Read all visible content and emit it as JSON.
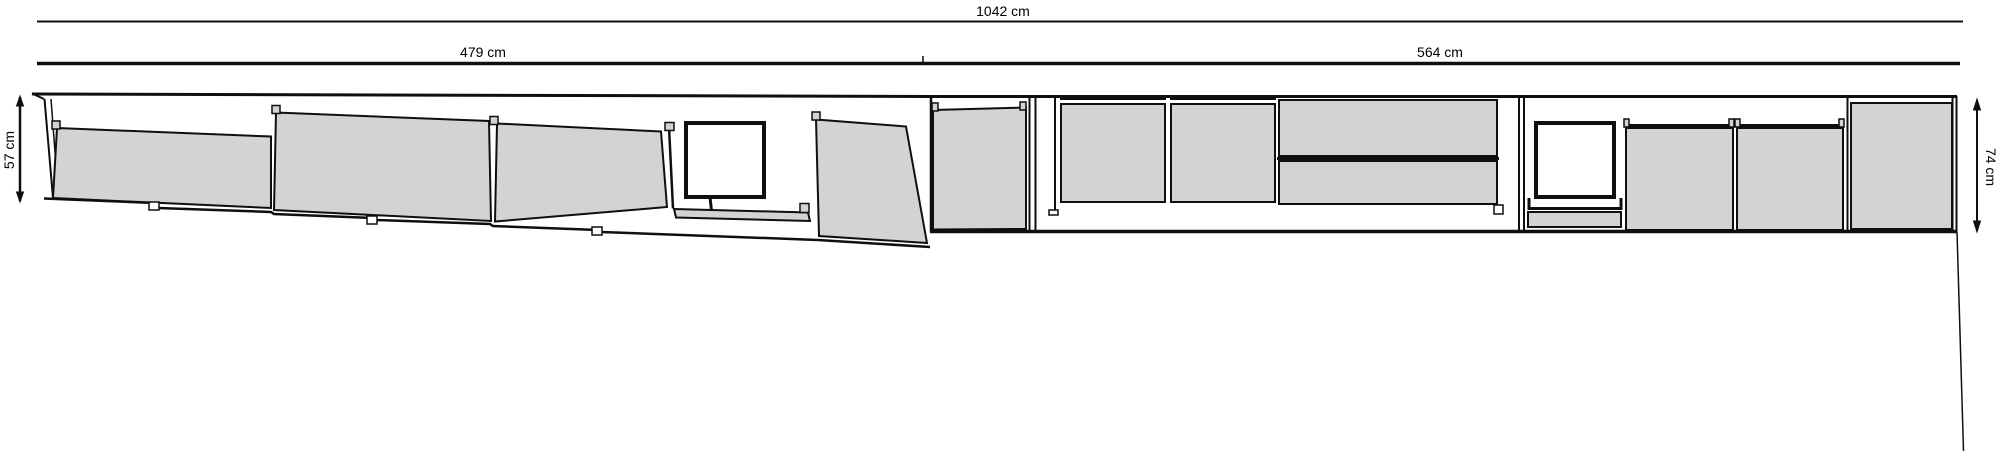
{
  "drawing": {
    "title": "cabinet-run-elevation",
    "colors": {
      "panel": "#d3d3d3",
      "stroke": "#0f0f0f",
      "background": "#ffffff",
      "white": "#ffffff"
    },
    "dimensions": {
      "total": {
        "label": "1042 cm"
      },
      "left_width": {
        "label": "479 cm"
      },
      "right_width": {
        "label": "564 cm"
      },
      "left_height": {
        "label": "57 cm"
      },
      "right_height": {
        "label": "74 cm"
      }
    },
    "groups": [
      {
        "name": "dimension-lines",
        "shapes": [
          {
            "k": "line",
            "p": [
              37,
              21.5,
              1963,
              21.5
            ],
            "s": 2,
            "name": "dim-line-total"
          },
          {
            "k": "line",
            "p": [
              37,
              63.5,
              923,
              63.5
            ],
            "s": 3.5,
            "name": "dim-line-left-width"
          },
          {
            "k": "line",
            "p": [
              923,
              63.5,
              1960,
              63.5
            ],
            "s": 3.5,
            "name": "dim-line-right-width"
          },
          {
            "k": "line",
            "p": [
              923,
              56,
              923,
              62
            ],
            "s": 1.5,
            "name": "dim-junction-tick"
          },
          {
            "k": "line",
            "p": [
              20,
              97,
              20,
              201
            ],
            "s": 2.5,
            "name": "dim-line-left-height"
          },
          {
            "k": "poly",
            "p": [
              16.5,
              106,
              23.5,
              106,
              20,
              96
            ],
            "f": "k",
            "s": 1,
            "name": "arrow-up-icon"
          },
          {
            "k": "poly",
            "p": [
              16.5,
              192,
              23.5,
              192,
              20,
              202
            ],
            "f": "k",
            "s": 1,
            "name": "arrow-down-icon"
          },
          {
            "k": "line",
            "p": [
              1977,
              100,
              1977,
              231
            ],
            "s": 2,
            "name": "dim-line-right-height"
          },
          {
            "k": "poly",
            "p": [
              1973.5,
              110,
              1980.5,
              110,
              1977,
              99
            ],
            "f": "k",
            "s": 1,
            "name": "arrow-up-icon"
          },
          {
            "k": "poly",
            "p": [
              1973.5,
              221,
              1980.5,
              221,
              1977,
              232
            ],
            "f": "k",
            "s": 1,
            "name": "arrow-down-icon"
          },
          {
            "k": "text",
            "x": 1003,
            "y": 16,
            "bind": "drawing.dimensions.total.label",
            "name": "dim-total-label"
          },
          {
            "k": "text",
            "x": 483,
            "y": 57,
            "bind": "drawing.dimensions.left_width.label",
            "name": "dim-left-width-label"
          },
          {
            "k": "text",
            "x": 1440,
            "y": 57,
            "bind": "drawing.dimensions.right_width.label",
            "name": "dim-right-width-label"
          },
          {
            "k": "text",
            "x": 14,
            "y": 150,
            "rot": -90,
            "bind": "drawing.dimensions.left_height.label",
            "name": "dim-left-height-label"
          },
          {
            "k": "text",
            "x": 1986,
            "y": 167,
            "rot": 90,
            "bind": "drawing.dimensions.right_height.label",
            "name": "dim-right-height-label"
          }
        ]
      },
      {
        "name": "left-run-oblique",
        "shapes": [
          {
            "k": "pline",
            "p": [
              44,
              198.5,
              155,
              203,
              158,
              208,
              271,
              212,
              274,
              214,
              373,
              218,
              376,
              220,
              490,
              224,
              493,
              226,
              598,
              230,
              601,
              232,
              818,
              240,
              930,
              247
            ],
            "s": 2.5,
            "name": "base-outline"
          },
          {
            "k": "line",
            "p": [
              32,
              94,
              930,
              96.5
            ],
            "s": 3,
            "name": "top-edge"
          },
          {
            "k": "line",
            "p": [
              32,
              93.5,
              44,
              99
            ],
            "s": 2,
            "name": "top-left-tip"
          },
          {
            "k": "line",
            "p": [
              44.5,
              99,
              53,
              198
            ],
            "s": 2,
            "name": "end-panel-edge"
          },
          {
            "k": "line",
            "p": [
              51,
              99,
              58.5,
              198
            ],
            "s": 1.5,
            "name": "end-panel-edge"
          },
          {
            "k": "poly",
            "p": [
              57,
              128,
              271,
              136.5,
              271,
              208,
              53,
              198
            ],
            "f": "g",
            "s": 2,
            "name": "panel-front"
          },
          {
            "k": "rect",
            "p": [
              52,
              121,
              8,
              8
            ],
            "f": "g",
            "s": 1.5,
            "name": "hinge-tab"
          },
          {
            "k": "poly",
            "p": [
              276,
              112.5,
              489,
              121,
              491,
              221,
              274,
              210
            ],
            "f": "g",
            "s": 2,
            "name": "panel-front"
          },
          {
            "k": "rect",
            "p": [
              272,
              105.5,
              8,
              8
            ],
            "f": "g",
            "s": 1.5,
            "name": "hinge-tab"
          },
          {
            "k": "poly",
            "p": [
              497,
              123.5,
              661,
              131.5,
              667,
              207,
              495,
              221.5
            ],
            "f": "g",
            "s": 2,
            "name": "panel-front"
          },
          {
            "k": "rect",
            "p": [
              490,
              116.5,
              8,
              8
            ],
            "f": "g",
            "s": 1.5,
            "name": "hinge-tab"
          },
          {
            "k": "line",
            "p": [
              669,
              127,
              673,
              208.5
            ],
            "s": 2.5,
            "name": "divider"
          },
          {
            "k": "rect",
            "p": [
              665,
              122.5,
              9,
              8
            ],
            "f": "g",
            "s": 1.5,
            "name": "hinge-tab"
          },
          {
            "k": "rect",
            "p": [
              686,
              123,
              78,
              74
            ],
            "f": "w",
            "s": 4,
            "name": "window-opening"
          },
          {
            "k": "line",
            "p": [
              710,
              197,
              711.5,
              211
            ],
            "s": 3,
            "name": "window-stem"
          },
          {
            "k": "poly",
            "p": [
              674,
              209,
              808,
              212.5,
              810,
              221,
              676,
              217.5
            ],
            "f": "g",
            "s": 2,
            "name": "sill-strip"
          },
          {
            "k": "rect",
            "p": [
              800,
              203.5,
              9,
              9
            ],
            "f": "g",
            "s": 1.5,
            "name": "hinge-tab"
          },
          {
            "k": "poly",
            "p": [
              816,
              119.5,
              906,
              126.5,
              927,
              243,
              819,
              236
            ],
            "f": "g",
            "s": 2,
            "name": "open-door-panel"
          },
          {
            "k": "rect",
            "p": [
              812,
              112,
              8,
              8
            ],
            "f": "g",
            "s": 1.5,
            "name": "hinge-tab"
          },
          {
            "k": "rect",
            "p": [
              149,
              202,
              10,
              8
            ],
            "f": "w",
            "s": 1.5,
            "name": "foot"
          },
          {
            "k": "rect",
            "p": [
              367,
              216,
              10,
              8
            ],
            "f": "w",
            "s": 1.5,
            "name": "foot"
          },
          {
            "k": "rect",
            "p": [
              592,
              227,
              10,
              8
            ],
            "f": "w",
            "s": 1.5,
            "name": "foot"
          }
        ]
      },
      {
        "name": "right-run-elevation",
        "shapes": [
          {
            "k": "poly",
            "p": [
              933,
              110,
              1026,
              107.5,
              1026,
              229,
              933,
              229.5
            ],
            "f": "g",
            "s": 2,
            "name": "base-door"
          },
          {
            "k": "rect",
            "p": [
              932,
              103,
              6,
              8
            ],
            "f": "g",
            "s": 1.5,
            "name": "hinge-tab"
          },
          {
            "k": "rect",
            "p": [
              1020,
              102,
              6,
              8
            ],
            "f": "g",
            "s": 1.5,
            "name": "hinge-tab"
          },
          {
            "k": "line",
            "p": [
              1029.5,
              97,
              1029.5,
              231
            ],
            "s": 2,
            "name": "divider"
          },
          {
            "k": "line",
            "p": [
              1035.5,
              97,
              1035.5,
              231
            ],
            "s": 2,
            "name": "divider"
          },
          {
            "k": "line",
            "p": [
              1055,
              98,
              1055,
              212
            ],
            "s": 2,
            "name": "side-edge"
          },
          {
            "k": "rect",
            "p": [
              1049,
              210,
              9,
              5
            ],
            "f": "w",
            "s": 1.5,
            "name": "foot"
          },
          {
            "k": "line",
            "p": [
              1060,
              99,
              1166,
              99
            ],
            "s": 2,
            "name": "cabinet-top-rail"
          },
          {
            "k": "rect",
            "p": [
              1061,
              104,
              104,
              98
            ],
            "f": "g",
            "s": 2,
            "name": "wall-door"
          },
          {
            "k": "line",
            "p": [
              1170,
              99,
              1276,
              99
            ],
            "s": 2,
            "name": "cabinet-top-rail"
          },
          {
            "k": "rect",
            "p": [
              1171,
              104,
              104,
              98
            ],
            "f": "g",
            "s": 2,
            "name": "wall-door"
          },
          {
            "k": "rect",
            "p": [
              1279,
              100,
              218,
              56
            ],
            "f": "g",
            "s": 2,
            "name": "drawer-front"
          },
          {
            "k": "line",
            "p": [
              1277,
              158.5,
              1499,
              158.5
            ],
            "s": 3,
            "name": "drawer-divider"
          },
          {
            "k": "rect",
            "p": [
              1279,
              161,
              218,
              43
            ],
            "f": "g",
            "s": 2,
            "name": "drawer-front"
          },
          {
            "k": "rect",
            "p": [
              1494,
              205,
              9,
              9
            ],
            "f": "w",
            "s": 1.5,
            "name": "foot"
          },
          {
            "k": "line",
            "p": [
              1519,
              97,
              1519,
              232
            ],
            "s": 2,
            "name": "side-panel"
          },
          {
            "k": "line",
            "p": [
              1524,
              97,
              1524,
              232
            ],
            "s": 2,
            "name": "side-panel"
          },
          {
            "k": "rect",
            "p": [
              1536,
              123,
              78,
              74
            ],
            "f": "w",
            "s": 4,
            "name": "window-opening"
          },
          {
            "k": "pline",
            "p": [
              1529,
              198,
              1529,
              208.5,
              1621,
              208.5,
              1621,
              198
            ],
            "s": 3,
            "name": "window-sill"
          },
          {
            "k": "rect",
            "p": [
              1528,
              212,
              93,
              15
            ],
            "f": "g",
            "s": 2,
            "name": "sill-strip"
          },
          {
            "k": "line",
            "p": [
              1625,
              125.5,
              1734,
              125.5
            ],
            "s": 3,
            "name": "cabinet-top-rail"
          },
          {
            "k": "rect",
            "p": [
              1624,
              119,
              5,
              8
            ],
            "f": "g",
            "s": 1.5,
            "name": "hinge-tab"
          },
          {
            "k": "rect",
            "p": [
              1729,
              119,
              5,
              8
            ],
            "f": "g",
            "s": 1.5,
            "name": "hinge-tab"
          },
          {
            "k": "rect",
            "p": [
              1626,
              128,
              107,
              102
            ],
            "f": "g",
            "s": 2,
            "name": "base-door"
          },
          {
            "k": "line",
            "p": [
              1736,
              125.5,
              1844,
              125.5
            ],
            "s": 3,
            "name": "cabinet-top-rail"
          },
          {
            "k": "rect",
            "p": [
              1735,
              119,
              5,
              8
            ],
            "f": "g",
            "s": 1.5,
            "name": "hinge-tab"
          },
          {
            "k": "rect",
            "p": [
              1839,
              119,
              5,
              8
            ],
            "f": "g",
            "s": 1.5,
            "name": "hinge-tab"
          },
          {
            "k": "rect",
            "p": [
              1737,
              128,
              106,
              102
            ],
            "f": "g",
            "s": 2,
            "name": "base-door"
          },
          {
            "k": "line",
            "p": [
              1847.5,
              97,
              1847.5,
              231
            ],
            "s": 2,
            "name": "divider"
          },
          {
            "k": "rect",
            "p": [
              1851,
              103,
              101,
              126
            ],
            "f": "g",
            "s": 2,
            "name": "tall-end-door"
          },
          {
            "k": "line",
            "p": [
              930,
              96.5,
              1957,
              96.5
            ],
            "s": 3,
            "name": "top-edge"
          },
          {
            "k": "line",
            "p": [
              930,
              231.5,
              1957,
              231.5
            ],
            "s": 3.5,
            "name": "bottom-edge"
          },
          {
            "k": "line",
            "p": [
              931,
              96,
              931,
              232
            ],
            "s": 2.5,
            "name": "left-edge"
          },
          {
            "k": "line",
            "p": [
              1952.5,
              96,
              1952.5,
              232
            ],
            "s": 2,
            "name": "right-edge"
          },
          {
            "k": "line",
            "p": [
              1956.5,
              96,
              1956.5,
              232
            ],
            "s": 2,
            "name": "right-edge"
          },
          {
            "k": "line",
            "p": [
              1957,
              232,
              1963.5,
              451
            ],
            "s": 1.5,
            "name": "corner-drop-line"
          }
        ]
      }
    ]
  }
}
